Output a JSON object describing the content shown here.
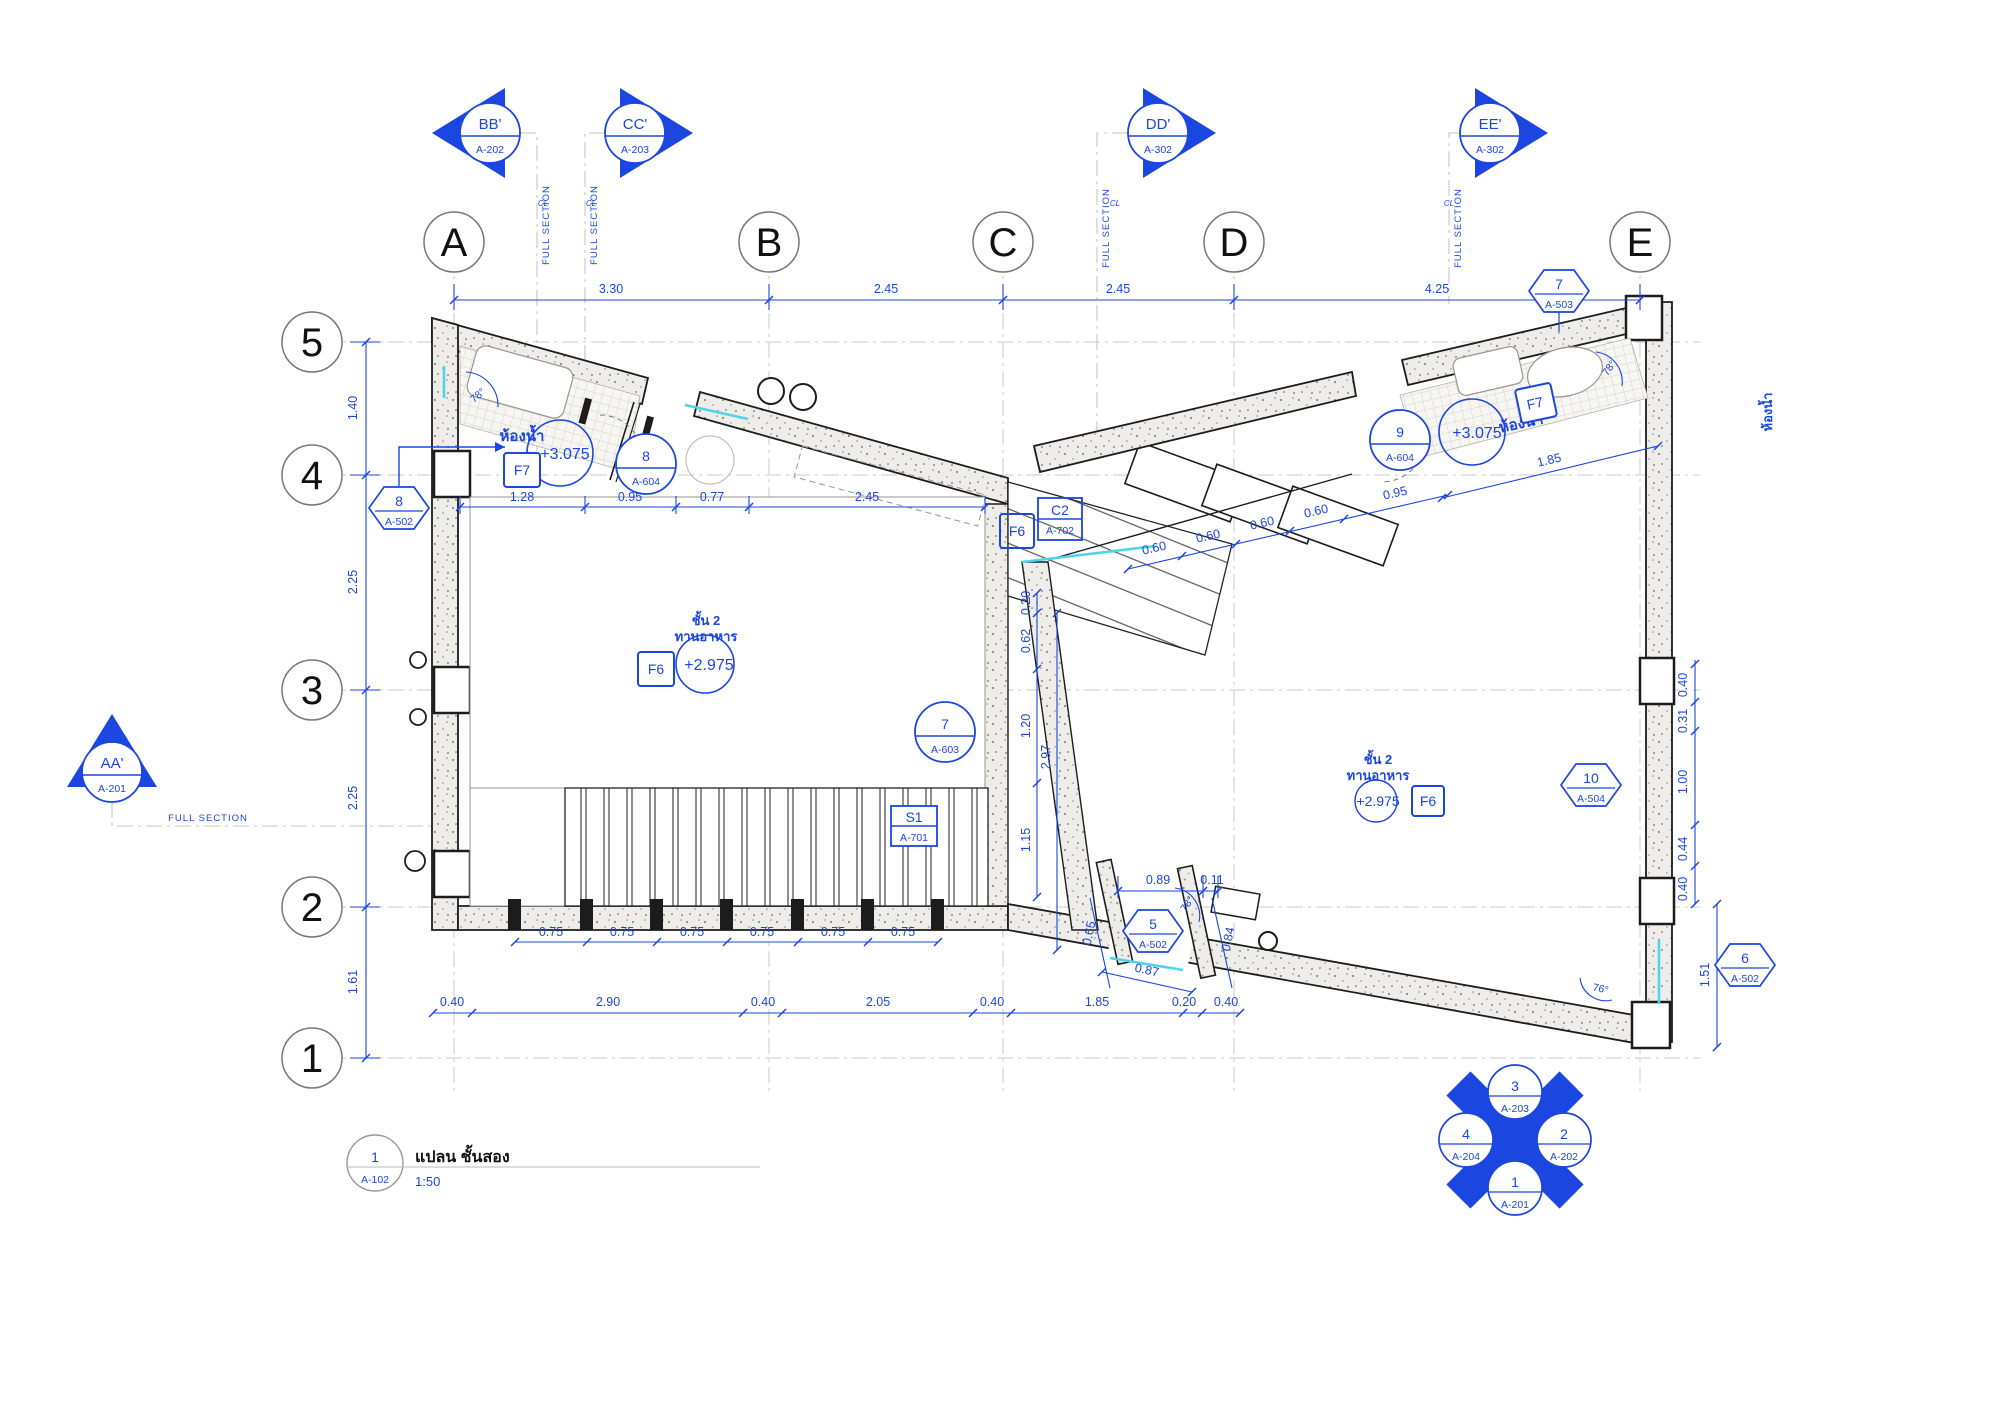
{
  "title_block": {
    "tag_number": "1",
    "tag_sheet": "A-102",
    "title": "แปลน ชั้นสอง",
    "scale": "1:50"
  },
  "grid": {
    "cols": [
      "A",
      "B",
      "C",
      "D",
      "E"
    ],
    "rows": [
      "5",
      "4",
      "3",
      "2",
      "1"
    ]
  },
  "sections": {
    "bb": {
      "label": "BB'",
      "sheet": "A-202"
    },
    "cc": {
      "label": "CC'",
      "sheet": "A-203"
    },
    "dd": {
      "label": "DD'",
      "sheet": "A-302"
    },
    "ee": {
      "label": "EE'",
      "sheet": "A-302"
    },
    "aa": {
      "label": "AA'",
      "sheet": "A-201"
    },
    "note": "FULL SECTION",
    "cl": "CL"
  },
  "tags": {
    "hex7": {
      "num": "7",
      "sheet": "A-503"
    },
    "hex8": {
      "num": "8",
      "sheet": "A-502"
    },
    "hex5": {
      "num": "5",
      "sheet": "A-502"
    },
    "hex6": {
      "num": "6",
      "sheet": "A-502"
    },
    "hex10": {
      "num": "10",
      "sheet": "A-504"
    },
    "c8": {
      "num": "8",
      "sheet": "A-604"
    },
    "c9": {
      "num": "9",
      "sheet": "A-604"
    },
    "c7": {
      "num": "7",
      "sheet": "A-603"
    },
    "s1": {
      "num": "S1",
      "sheet": "A-701"
    },
    "c2": {
      "num": "C2",
      "sheet": "A-702"
    }
  },
  "finishes": {
    "f7": "F7",
    "f6": "F6"
  },
  "rooms": {
    "bath": "ห้องน้ำ",
    "dining_line1": "ชั้น 2",
    "dining_line2": "ทานอาหาร",
    "level_bath": "+3.075",
    "level_dining": "+2.975"
  },
  "dims": {
    "top": [
      "3.30",
      "2.45",
      "2.45",
      "4.25"
    ],
    "left": [
      "1.40",
      "2.25",
      "2.25",
      "1.61"
    ],
    "roomtop": [
      "1.28",
      "0.95",
      "0.77",
      "2.45"
    ],
    "slope": [
      "0.60",
      "0.60",
      "0.60",
      "0.60",
      "0.95",
      "1.85"
    ],
    "centerv": [
      "0.20",
      "0.62",
      "1.20",
      "1.15",
      "2.97"
    ],
    "bottom": [
      "0.40",
      "2.90",
      "0.40",
      "2.05",
      "0.40",
      "1.85",
      "0.20",
      "0.40"
    ],
    "posts": [
      "0.75",
      "0.75",
      "0.75",
      "0.75",
      "0.75",
      "0.75"
    ],
    "deck": [
      "0.89",
      "0.11",
      "0.65",
      "0.84",
      "0.87"
    ],
    "right": [
      "0.40",
      "0.31",
      "1.00",
      "0.44",
      "0.40",
      "1.51"
    ]
  },
  "angles": {
    "a78": "78°",
    "a76": "76°"
  },
  "compass": {
    "top": {
      "num": "3",
      "sheet": "A-203"
    },
    "right": {
      "num": "2",
      "sheet": "A-202"
    },
    "bottom": {
      "num": "1",
      "sheet": "A-201"
    },
    "left": {
      "num": "4",
      "sheet": "A-204"
    }
  }
}
